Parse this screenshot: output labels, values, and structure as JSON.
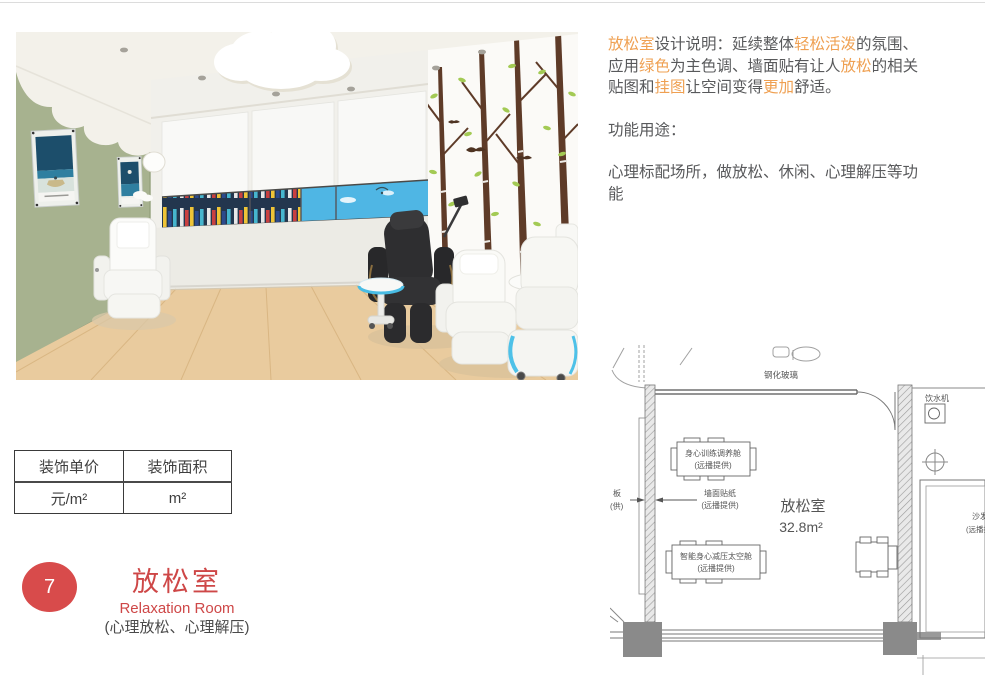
{
  "colors": {
    "brand_red": "#d84b4b",
    "accent_orange": "#efa052",
    "body_text": "#58595b",
    "wall_green": "#a7b28f",
    "floor_wood": "#e9cb9e",
    "window_blue": "#3fa6d6"
  },
  "description": {
    "segments": [
      {
        "t": "放松室",
        "hl": true
      },
      {
        "t": "设计说明：延续整体"
      },
      {
        "t": "轻松活泼",
        "hl": true
      },
      {
        "t": "的氛围、\n应用"
      },
      {
        "t": "绿色",
        "hl": true
      },
      {
        "t": "为主色调、墙面贴有让人"
      },
      {
        "t": "放松",
        "hl": true
      },
      {
        "t": "的相关\n贴图和"
      },
      {
        "t": "挂图",
        "hl": true
      },
      {
        "t": "让空间变得"
      },
      {
        "t": "更加",
        "hl": true
      },
      {
        "t": "舒适。"
      }
    ],
    "function_heading": "功能用途：",
    "function_body": "心理标配场所，做放松、休闲、心理解压等功\n能"
  },
  "plan": {
    "glass_label": "钢化玻璃",
    "room_name": "放松室",
    "room_area": "32.8m²",
    "equipment_top": [
      "身心训练调养舱",
      "(远播提供)"
    ],
    "wall_sticker": [
      "墙面贴纸",
      "(远播提供)"
    ],
    "equipment_bottom": [
      "智能身心减压太空舱",
      "(远播提供)"
    ],
    "left_edge_partial": [
      "板",
      "(供)"
    ],
    "water_dispenser": "饮水机",
    "sofa": [
      "沙发",
      "(远播提供)"
    ]
  },
  "table": {
    "headers": [
      "装饰单价",
      "装饰面积"
    ],
    "units": [
      "元/m²",
      "m²"
    ]
  },
  "badge": {
    "number": "7",
    "title_cn": "放松室",
    "title_en": "Relaxation Room",
    "subtitle": "(心理放松、心理解压)"
  }
}
